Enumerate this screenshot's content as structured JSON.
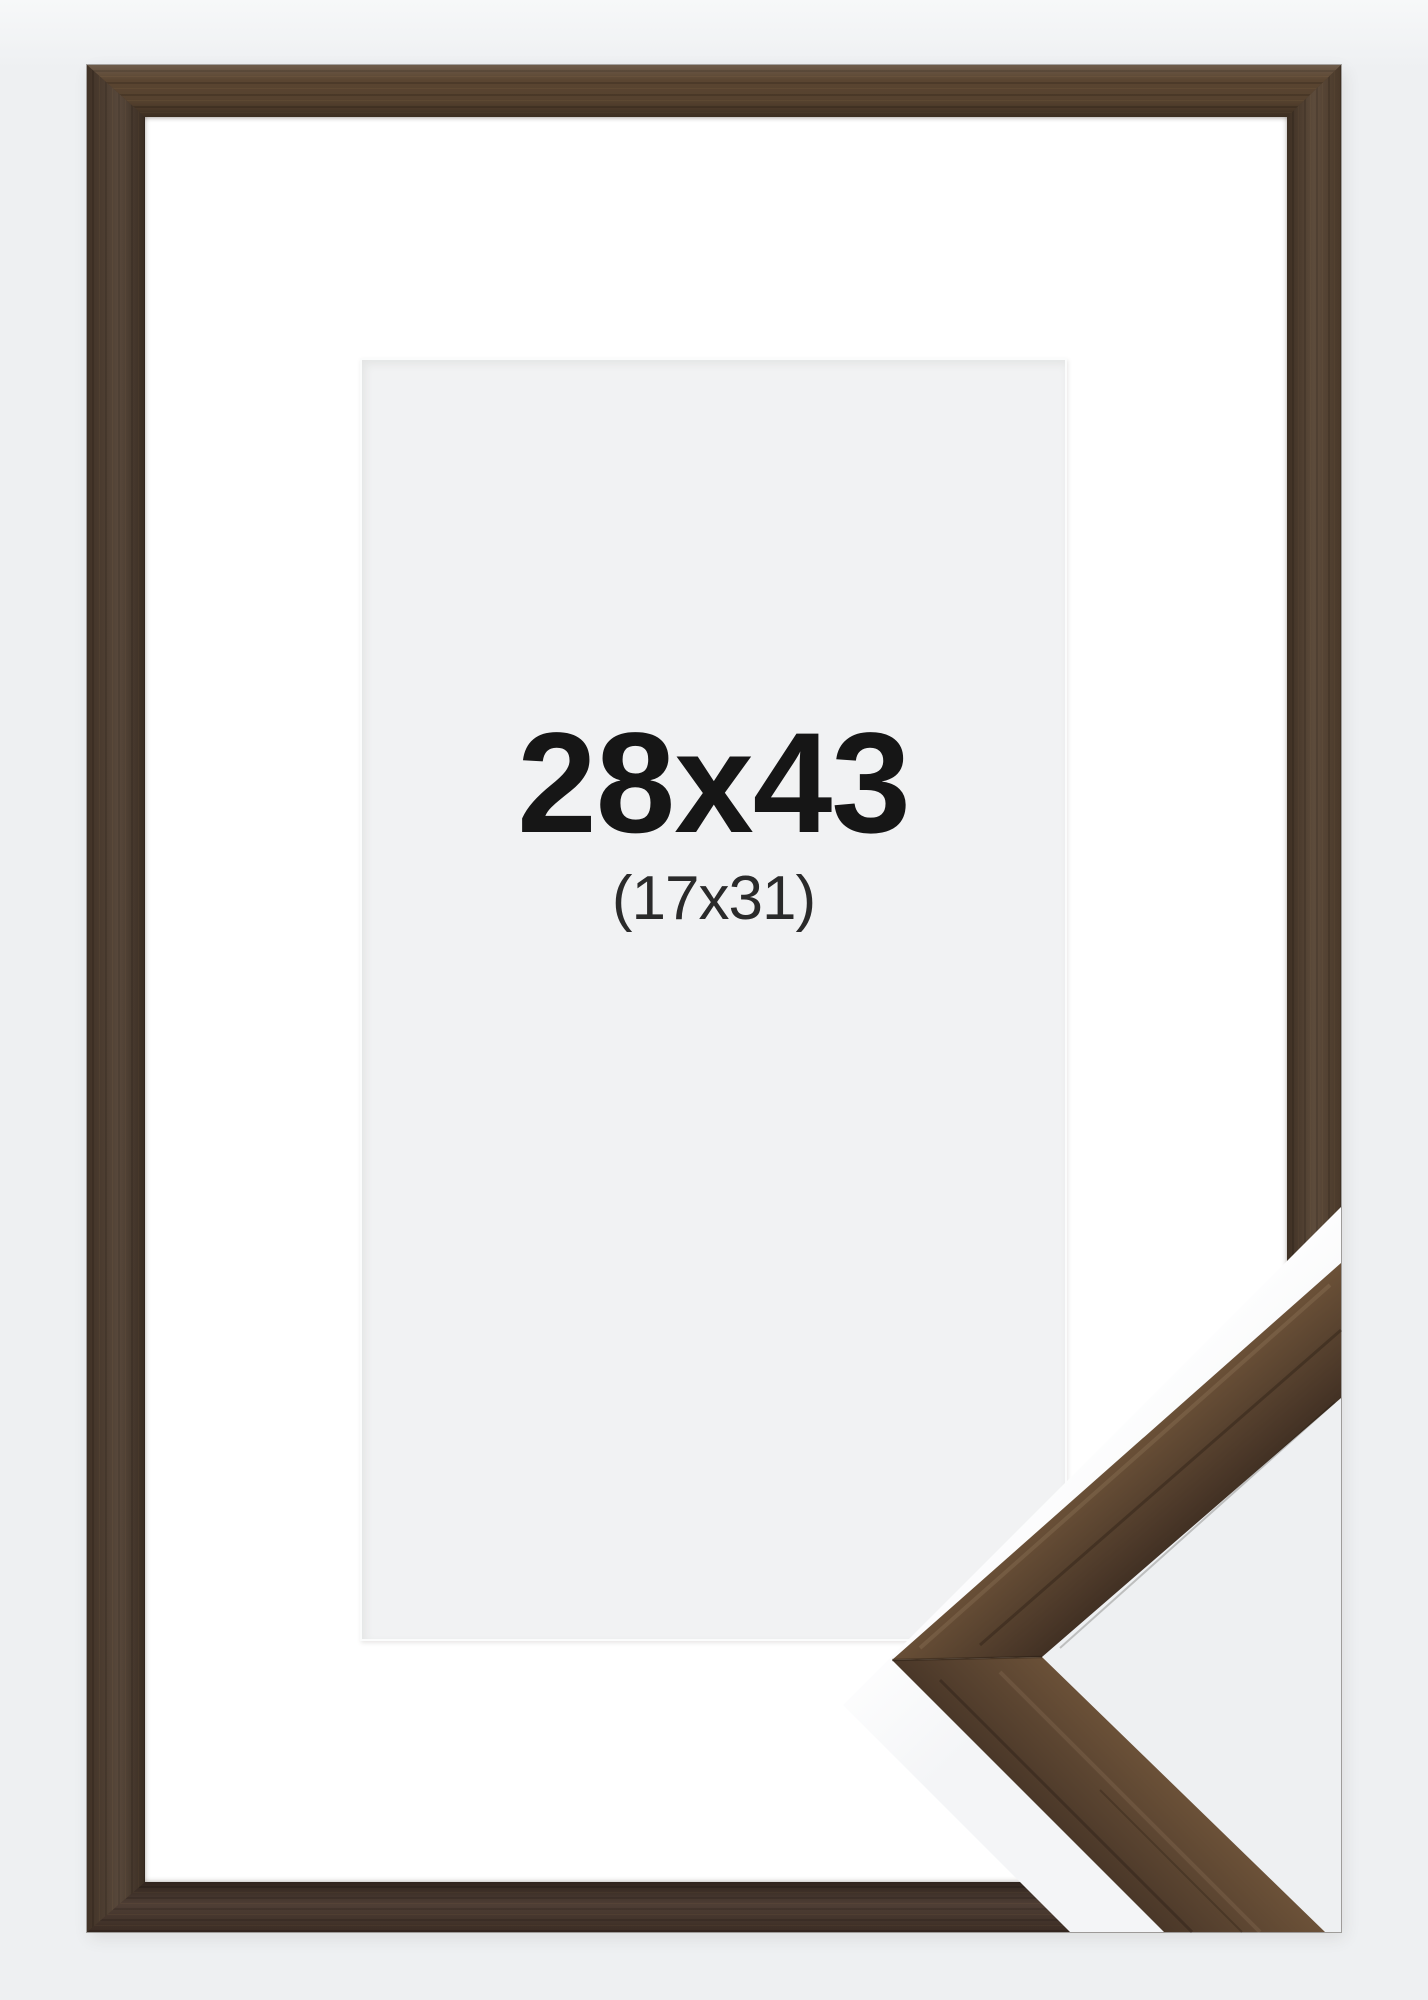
{
  "product": {
    "outer_size_label": "28x43",
    "inner_size_label": "(17x31)"
  },
  "colors": {
    "page_background": "#eef0f2",
    "frame_wood_base": "#53402f",
    "frame_wood_dark": "#36281e",
    "frame_wood_light": "#6e5339",
    "mat": "#ffffff",
    "paper": "#f1f2f3",
    "label_text": "#161616",
    "wedge_white": "#ffffff"
  }
}
